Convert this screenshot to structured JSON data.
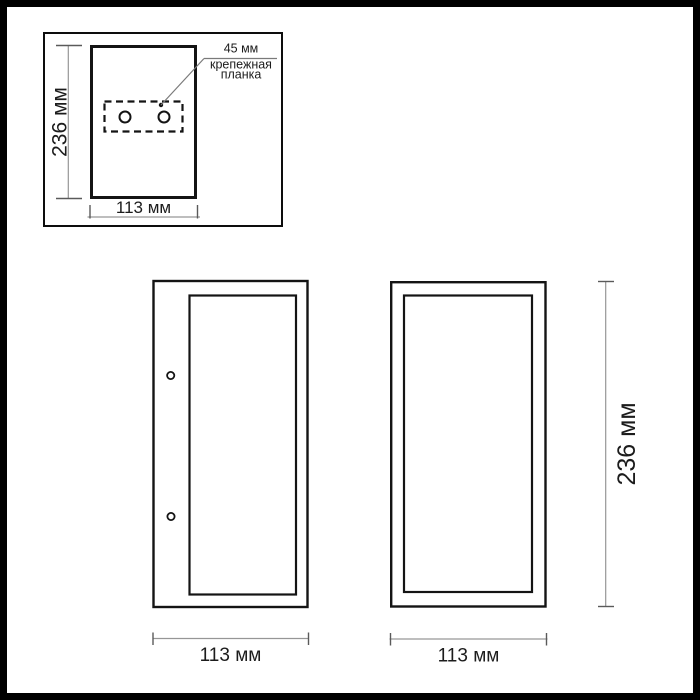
{
  "colors": {
    "background": "#ffffff",
    "frame": "#000000",
    "outline": "#141414",
    "dimension_line": "#969696",
    "dimension_tick": "#5a5a5a",
    "text": "#1c1c1c"
  },
  "inset_rear_view": {
    "height_label": "236 мм",
    "width_label": "113 мм",
    "callout": {
      "size_label": "45 мм",
      "name_line1": "крепежная",
      "name_line2": "планка"
    }
  },
  "side_view": {
    "width_label": "113 мм"
  },
  "front_view": {
    "width_label": "113 мм",
    "height_label": "236 мм"
  }
}
